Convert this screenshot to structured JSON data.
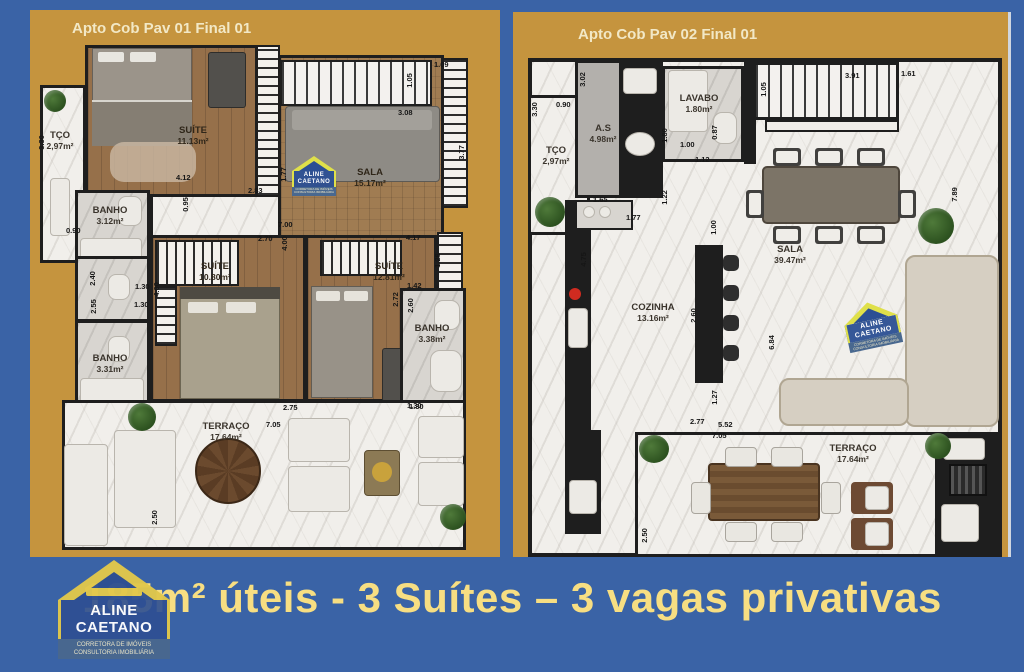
{
  "colors": {
    "background_blue": "#3a63a6",
    "panel_gold": "#c5943e",
    "banner_text_yellow": "#f7de82",
    "wall_dark": "#1e1e1e",
    "logo_blue": "#2b4f94",
    "logo_yellow": "#dfe04a"
  },
  "banner": {
    "text": "185m² úteis - 3 Suítes – 3 vagas privativas"
  },
  "logo": {
    "line1": "ALINE",
    "line2": "CAETANO",
    "sub1": "CORRETORA DE IMÓVEIS",
    "sub2": "CONSULTORIA IMOBILIÁRIA"
  },
  "plans": [
    {
      "title": "Apto Cob Pav 01 Final 01",
      "rooms": [
        {
          "name": "TÇO",
          "area": "2,97m²"
        },
        {
          "name": "SUÍTE",
          "area": "11.13m²"
        },
        {
          "name": "SALA",
          "area": "15.17m²"
        },
        {
          "name": "BANHO",
          "area": "3.12m²"
        },
        {
          "name": "SUÍTE",
          "area": "10.80m²"
        },
        {
          "name": "SUÍTE",
          "area": "12.81m²"
        },
        {
          "name": "BANHO",
          "area": "3.31m²"
        },
        {
          "name": "BANHO",
          "area": "3.38m²"
        },
        {
          "name": "TERRAÇO",
          "area": "17.64m²"
        }
      ],
      "dims": [
        "1.09",
        "1.05",
        "3.08",
        "3.77",
        "4.12",
        "2.83",
        "0.95",
        "1.77",
        "7.00",
        "2.70",
        "3.30",
        "0.90",
        "2.40",
        "1.30",
        "2.55",
        "1.30",
        "4.00",
        "4.17",
        "1.28",
        "1.42",
        "2.60",
        "2.72",
        "1.30",
        "2.75",
        "1.30",
        "7.05",
        "2.50",
        "4.00"
      ]
    },
    {
      "title": "Apto Cob Pav 02 Final 01",
      "rooms": [
        {
          "name": "TÇO",
          "area": "2,97m²"
        },
        {
          "name": "A.S",
          "area": "4.98m²"
        },
        {
          "name": "LAVABO",
          "area": "1.80m²"
        },
        {
          "name": "COZINHA",
          "area": "13.16m²"
        },
        {
          "name": "SALA",
          "area": "39.47m²"
        },
        {
          "name": "TERRAÇO",
          "area": "17.64m²"
        }
      ],
      "dims": [
        "3.30",
        "0.90",
        "3.02",
        "1.80",
        "1.00",
        "1.12",
        "0.87",
        "3.91",
        "1.61",
        "1.05",
        "7.89",
        "1.65",
        "1.77",
        "4.75",
        "1.22",
        "1.00",
        "2.60",
        "6.84",
        "1.27",
        "2.77",
        "5.52",
        "7.05",
        "2.50"
      ]
    }
  ]
}
